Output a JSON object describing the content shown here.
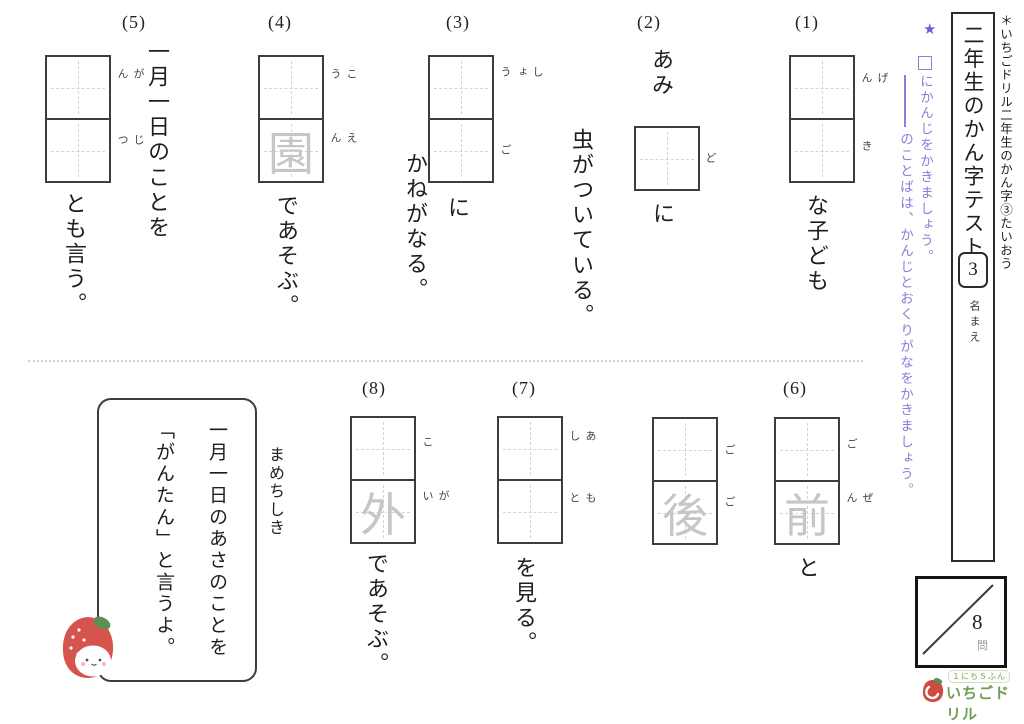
{
  "colors": {
    "instruction_purple": "#8c7fd4",
    "star_purple": "#6f5ecc",
    "ghost_gray": "#c6c6c6",
    "logo_green": "#6f9d55",
    "strawberry_red": "#d6544e"
  },
  "sidebar": {
    "header_note": "＊いちごドリル二年生のかん字③たいおう",
    "title": "二年生のかん字テスト",
    "test_number": "3",
    "name_label": "名まえ"
  },
  "instructions": {
    "star": "★",
    "box_symbol": "□",
    "line1": "にかんじをかきましょう。",
    "line2": "のことばは、かんじとおくりがなをかきましょう。"
  },
  "questions": [
    {
      "label": "(1)",
      "pre": "",
      "boxes": [
        {
          "furigana": "げん",
          "ghost": ""
        },
        {
          "furigana": "き",
          "ghost": ""
        }
      ],
      "after": "な子ども",
      "tail": ""
    },
    {
      "label": "(2)",
      "pre": "あみ",
      "boxes": [
        {
          "furigana": "ど",
          "ghost": ""
        }
      ],
      "after": "に",
      "tail": "虫がついている。"
    },
    {
      "label": "(3)",
      "pre": "",
      "boxes": [
        {
          "furigana": "しょう",
          "ghost": ""
        },
        {
          "furigana": "ご",
          "ghost": ""
        }
      ],
      "after": "に",
      "tail": "かねがなる。"
    },
    {
      "label": "(4)",
      "pre": "",
      "boxes": [
        {
          "furigana": "こう",
          "ghost": ""
        },
        {
          "furigana": "えん",
          "ghost": "園"
        }
      ],
      "after": "であそぶ。",
      "tail": ""
    },
    {
      "label": "(5)",
      "pre": "一月一日のことを",
      "boxes": [
        {
          "furigana": "がん",
          "ghost": ""
        },
        {
          "furigana": "じつ",
          "ghost": ""
        }
      ],
      "after": "とも言う。",
      "tail": ""
    },
    {
      "label": "(6)",
      "pre": "",
      "boxes": [
        {
          "furigana": "ご",
          "ghost": ""
        },
        {
          "furigana": "ぜん",
          "ghost": "前"
        }
      ],
      "mid": "と",
      "boxes2": [
        {
          "furigana": "ご",
          "ghost": ""
        },
        {
          "furigana": "ご",
          "ghost": "後"
        }
      ],
      "after": "",
      "tail": ""
    },
    {
      "label": "(7)",
      "pre": "",
      "boxes": [
        {
          "furigana": "あし",
          "ghost": ""
        },
        {
          "furigana": "もと",
          "ghost": ""
        }
      ],
      "after": "を見る。",
      "tail": ""
    },
    {
      "label": "(8)",
      "pre": "",
      "boxes": [
        {
          "furigana": "こ",
          "ghost": ""
        },
        {
          "furigana": "がい",
          "ghost": "外"
        }
      ],
      "after": "であそぶ。",
      "tail": ""
    }
  ],
  "trivia": {
    "label": "まめちしき",
    "line1": "一月一日のあさのことを",
    "line2": "「がんたん」と言うよ。"
  },
  "score_box": {
    "total": "8",
    "unit": "問"
  },
  "logo": {
    "tagline": "１にち５ふん",
    "name": "いちごドリル"
  }
}
